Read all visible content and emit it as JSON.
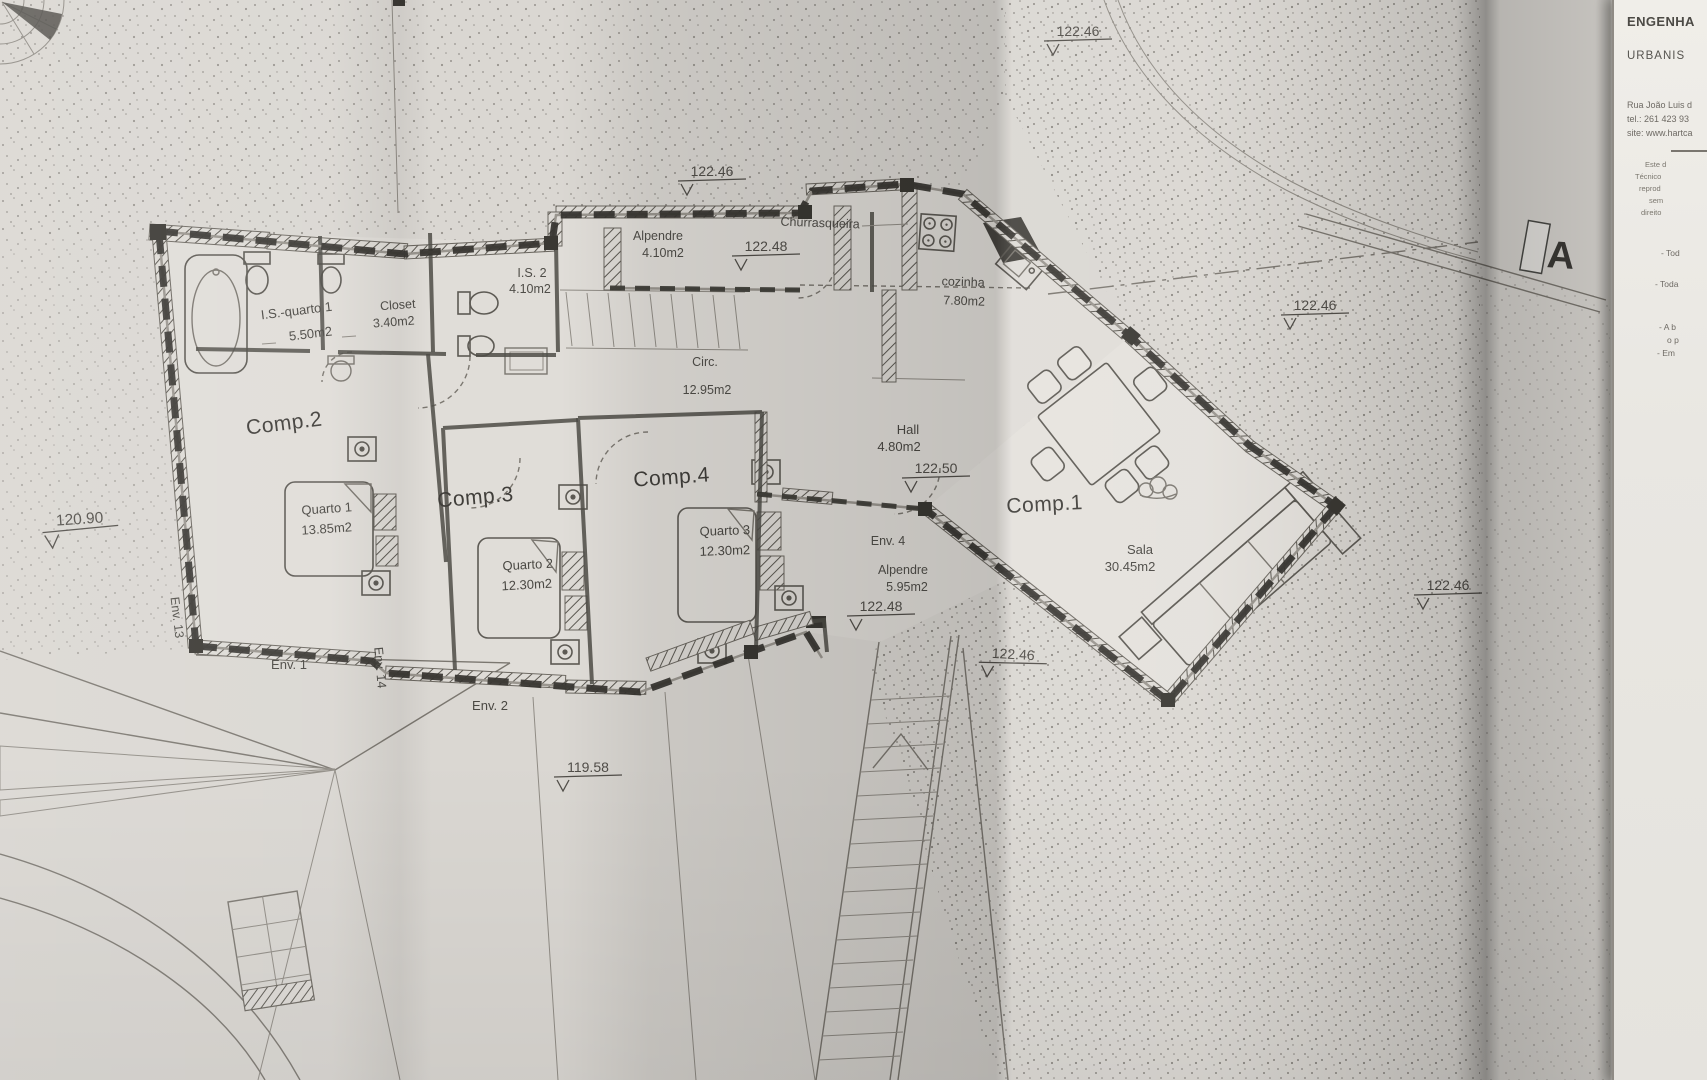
{
  "titleblock": {
    "company_line1": "ENGENHA",
    "company_line2": "URBANIS",
    "address_lines": [
      "Rua João Luis d",
      "tel.: 261 423 93",
      "site: www.hartca"
    ],
    "notice_lines": [
      "Este d",
      "Técnico",
      "reprod",
      "sem",
      "direito"
    ],
    "note_lines": [
      "- Tod",
      "- Toda",
      "- A b",
      "o p",
      "- Em"
    ]
  },
  "plan": {
    "section_marker": "A",
    "labels": {
      "alpendre_n": "Alpendre",
      "alpendre_n_area": "4.10m2",
      "churrasqueira": "Churrasqueira",
      "cozinha": "cozinha",
      "cozinha_area": "7.80m2",
      "is2": "I.S. 2",
      "is2_area": "4.10m2",
      "closet": "Closet",
      "closet_area": "3.40m2",
      "is_q1": "I.S.-quarto 1",
      "is_q1_area": "5.50m2",
      "circ": "Circ.",
      "circ_area": "12.95m2",
      "comp2": "Comp.2",
      "comp2_sub": "Quarto 1",
      "comp2_area": "13.85m2",
      "comp3": "Comp.3",
      "comp3_sub": "Quarto 2",
      "comp3_area": "12.30m2",
      "comp4": "Comp.4",
      "comp4_sub": "Quarto 3",
      "comp4_area": "12.30m2",
      "hall": "Hall",
      "hall_area": "4.80m2",
      "comp1": "Comp.1",
      "comp1_sub": "Sala",
      "comp1_area": "30.45m2",
      "env4": "Env. 4",
      "env4_sub": "Alpendre",
      "env4_area": "5.95m2",
      "env1": "Env. 1",
      "env2": "Env. 2",
      "env13": "Env. 13",
      "env14": "Env. 14"
    },
    "elevations": {
      "top_center": "122.46",
      "porch": "122.48",
      "top_right": "122.46",
      "right_mid": "122.46",
      "hall": "122.50",
      "env4": "122.48",
      "stairs": "122.46",
      "far_right": "122.46",
      "left": "120.90",
      "bottom": "119.58"
    }
  }
}
